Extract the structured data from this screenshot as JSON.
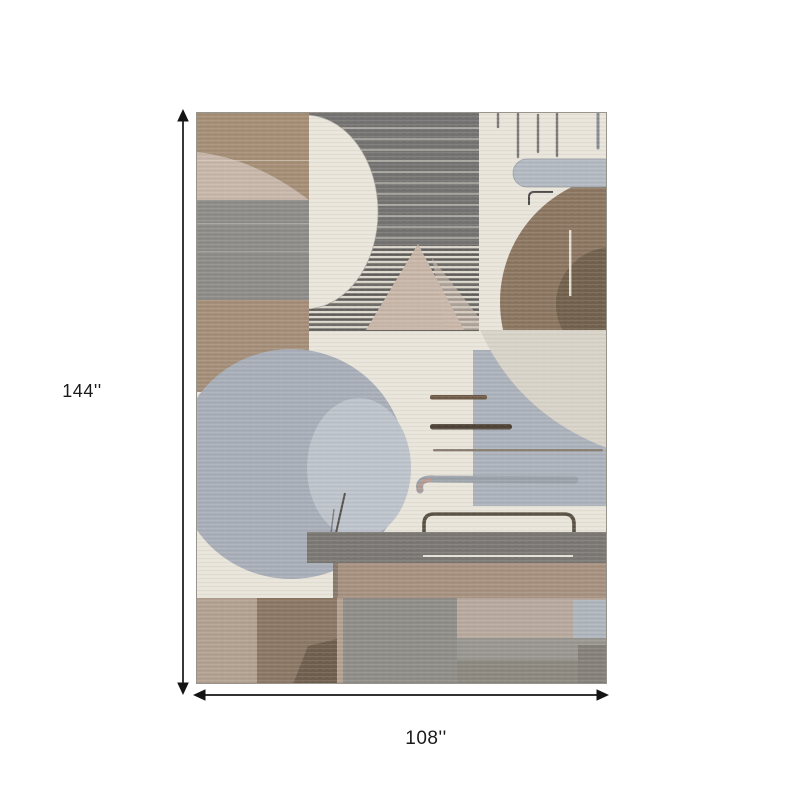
{
  "diagram": {
    "type": "product-dimension-diagram",
    "product": "abstract geometric area rug in gray, taupe, brown and cream",
    "height_label": "144''",
    "width_label": "108''"
  },
  "rug_palette": {
    "cream": "#e8e4da",
    "taupe_tan": "#a58e76",
    "mid_gray": "#8d8c89",
    "panel_dark_gray": "#757371",
    "brown_disc": "#8b7661",
    "dark_brown": "#6f5f4b",
    "blue_gray": "#a8aeb8",
    "light_blue_gray": "#bdc3cb",
    "mottled_greige": "#d8d3c8",
    "dimension_line": "#141414"
  }
}
